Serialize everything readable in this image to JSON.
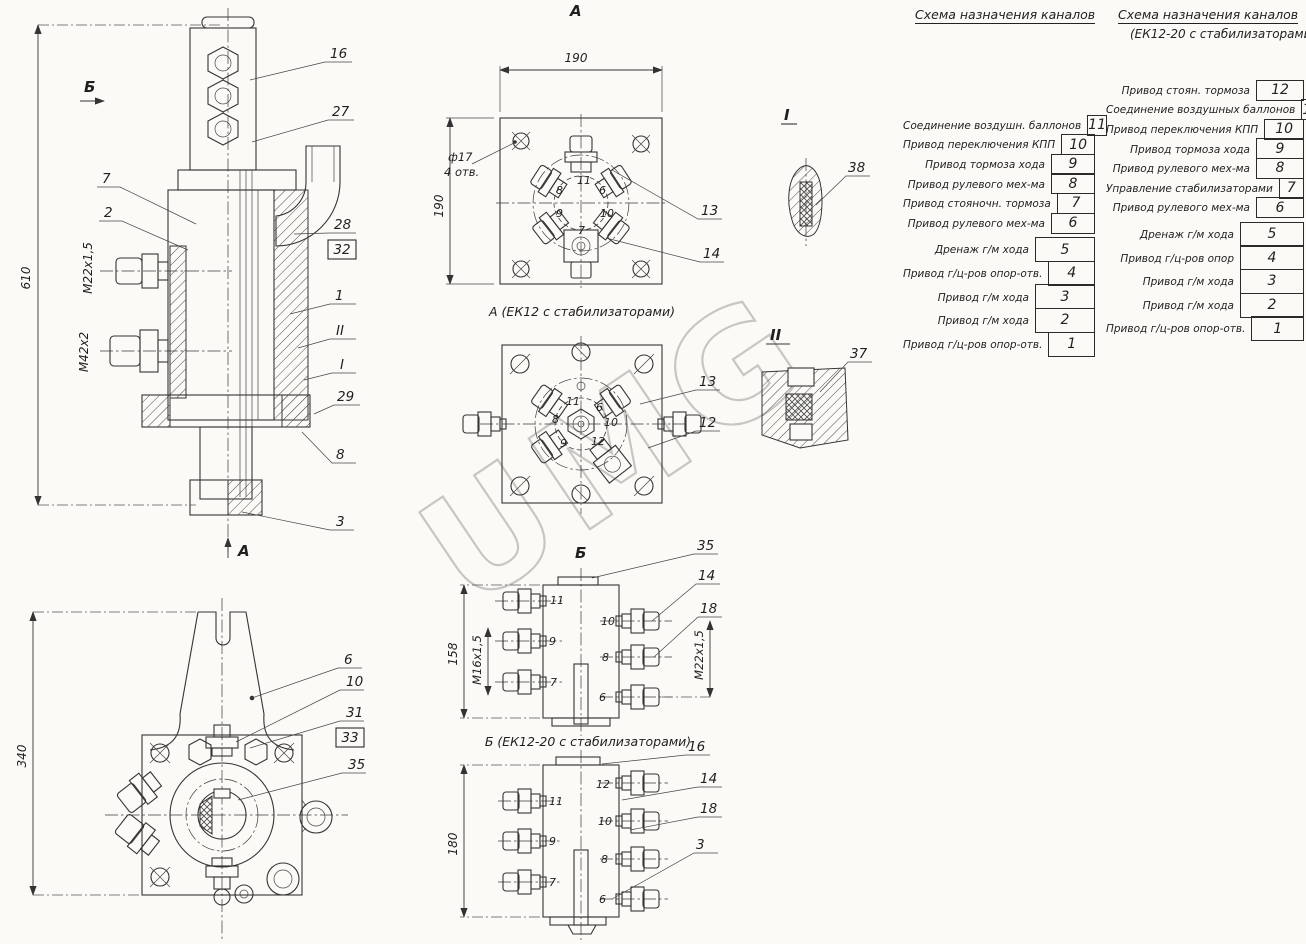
{
  "watermark": "UMG",
  "tables": {
    "left": {
      "title": "Схема назначения каналов",
      "rows_top": [
        {
          "label": "Соединение воздушн. баллонов",
          "num": "11"
        },
        {
          "label": "Привод переключения КПП",
          "num": "10"
        },
        {
          "label": "Привод тормоза хода",
          "num": "9"
        },
        {
          "label": "Привод рулевого мех-ма",
          "num": "8"
        },
        {
          "label": "Привод стояночн. тормоза",
          "num": "7"
        },
        {
          "label": "Привод рулевого мех-ма",
          "num": "6"
        }
      ],
      "rows_bottom": [
        {
          "label": "Дренаж г/м хода",
          "num": "5"
        },
        {
          "label": "Привод г/ц-ров опор-отв.",
          "num": "4"
        },
        {
          "label": "Привод г/м хода",
          "num": "3"
        },
        {
          "label": "Привод г/м хода",
          "num": "2"
        },
        {
          "label": "Привод г/ц-ров опор-отв.",
          "num": "1"
        }
      ]
    },
    "right": {
      "title": "Схема назначения каналов",
      "subtitle": "(ЕК12-20 с стабилизаторами)",
      "rows_top": [
        {
          "label": "Привод стоян. тормоза",
          "num": "12"
        },
        {
          "label": "Соединение воздушных баллонов",
          "num": "11"
        },
        {
          "label": "Привод переключения КПП",
          "num": "10"
        },
        {
          "label": "Привод тормоза хода",
          "num": "9"
        },
        {
          "label": "Привод рулевого мех-ма",
          "num": "8"
        },
        {
          "label": "Управление стабилизаторами",
          "num": "7"
        },
        {
          "label": "Привод рулевого мех-ма",
          "num": "6"
        }
      ],
      "rows_bottom": [
        {
          "label": "Дренаж г/м хода",
          "num": "5"
        },
        {
          "label": "Привод г/ц-ров опор",
          "num": "4"
        },
        {
          "label": "Привод г/м хода",
          "num": "3"
        },
        {
          "label": "Привод г/м хода",
          "num": "2"
        },
        {
          "label": "Привод г/ц-ров опор-отв.",
          "num": "1"
        }
      ]
    }
  },
  "main_view": {
    "dim_total": "610",
    "thread_upper": "М22х1,5",
    "thread_lower": "М42х2",
    "arrow_top": "Б",
    "arrow_bottom": "А",
    "callouts": {
      "c16": "16",
      "c27": "27",
      "c7": "7",
      "c2": "2",
      "c28": "28",
      "c32": "32",
      "c1": "1",
      "cII": "II",
      "cI": "I",
      "c29": "29",
      "c8": "8",
      "c3": "3"
    }
  },
  "flange_a": {
    "label": "А",
    "caption": "А (ЕК12 с стабилизаторами)",
    "dim_w": "190",
    "dim_h": "190",
    "hole_note1": "ф17",
    "hole_note2": "4 отв.",
    "ports": {
      "p8": "8",
      "p11": "11",
      "p6": "6",
      "p9": "9",
      "p10": "10",
      "p7": "7"
    },
    "callouts": {
      "c13": "13",
      "c14": "14"
    }
  },
  "flange_b": {
    "label": "Б",
    "ports": {
      "p11": "11",
      "p6": "6",
      "p8": "8",
      "p10": "10",
      "p9": "9",
      "p12": "12"
    },
    "callouts": {
      "c13": "13",
      "c12": "12"
    }
  },
  "side1": {
    "caption": "Б (ЕК12-20 с стабилизаторами)",
    "dim_h": "158",
    "thread_left": "М16х1,5",
    "thread_right": "М22х1,5",
    "ports": {
      "p11": "11",
      "p9": "9",
      "p7": "7",
      "p10": "10",
      "p8": "8",
      "p6": "6"
    },
    "callouts": {
      "c35": "35",
      "c14": "14",
      "c18": "18"
    }
  },
  "side2": {
    "dim_h": "180",
    "ports": {
      "p12": "12",
      "p11": "11",
      "p10": "10",
      "p9": "9",
      "p8": "8",
      "p7": "7",
      "p6": "6"
    },
    "callouts": {
      "c16": "16",
      "c14": "14",
      "c18": "18",
      "c3": "3"
    }
  },
  "detail1": {
    "label": "I",
    "callout": "38"
  },
  "detail2": {
    "label": "II",
    "callout": "37"
  },
  "bottom_view": {
    "dim_h": "340",
    "callouts": {
      "c6": "6",
      "c10": "10",
      "c31": "31",
      "c33": "33",
      "c35": "35"
    }
  }
}
